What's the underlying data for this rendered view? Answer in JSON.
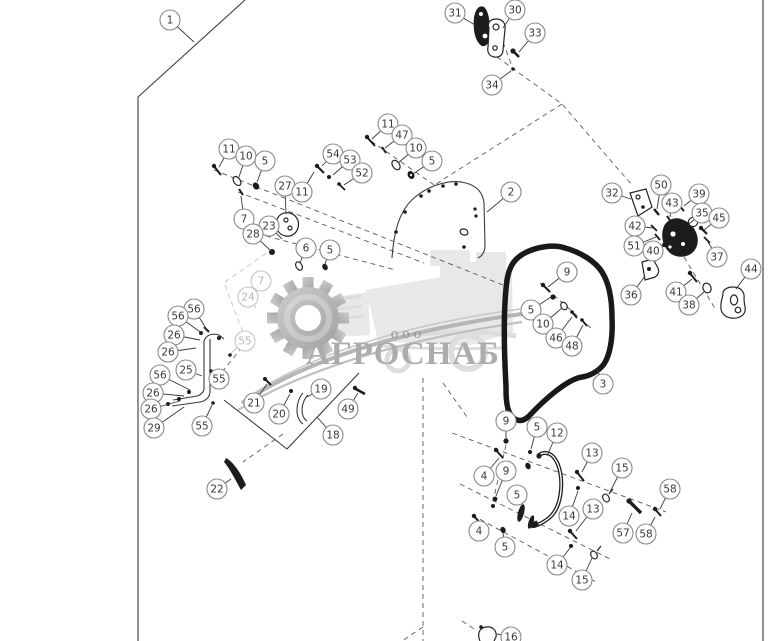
{
  "watermark": {
    "company": "АГРОСНАБ",
    "org_prefix": "ооо",
    "text_color": "#a8a8a8",
    "prefix_color": "#8f8f8f",
    "graphic_color": "#e7e7e7",
    "gear_light": "#cacaca",
    "gear_dark": "#9d9d9d"
  },
  "colors": {
    "background": "#ffffff",
    "border_line": "#3a3a3a",
    "dashed_line": "#5a5a5a",
    "leader_line": "#3a3a3a",
    "part_dark": "#1c1c1c",
    "seal": "#191919",
    "callout_stroke": "#8a8a8a",
    "callout_fill": "#ffffff",
    "callout_text": "#3a3a3a",
    "callout_light_stroke": "#c4c4c4",
    "callout_light_text": "#b8b8b8"
  },
  "callouts": [
    {
      "n": "1",
      "x": 170,
      "y": 20,
      "lx": 194,
      "ly": 42
    },
    {
      "n": "2",
      "x": 511,
      "y": 192,
      "lx": 487,
      "ly": 212
    },
    {
      "n": "3",
      "x": 603,
      "y": 384,
      "lx": 597,
      "ly": 369
    },
    {
      "n": "31",
      "x": 455,
      "y": 13,
      "lx": 475,
      "ly": 25
    },
    {
      "n": "30",
      "x": 515,
      "y": 10,
      "lx": 503,
      "ly": 28
    },
    {
      "n": "33",
      "x": 535,
      "y": 33,
      "lx": 519,
      "ly": 52
    },
    {
      "n": "34",
      "x": 492,
      "y": 85,
      "lx": 511,
      "ly": 71
    },
    {
      "n": "11",
      "x": 229,
      "y": 149,
      "lx": 219,
      "ly": 167
    },
    {
      "n": "10",
      "x": 246,
      "y": 156,
      "lx": 239,
      "ly": 177
    },
    {
      "n": "5",
      "x": 265,
      "y": 161,
      "lx": 257,
      "ly": 182
    },
    {
      "n": "54",
      "x": 333,
      "y": 154,
      "lx": 322,
      "ly": 166
    },
    {
      "n": "53",
      "x": 350,
      "y": 160,
      "lx": 333,
      "ly": 175
    },
    {
      "n": "52",
      "x": 362,
      "y": 173,
      "lx": 344,
      "ly": 185
    },
    {
      "n": "27",
      "x": 285,
      "y": 186,
      "lx": 286,
      "ly": 214
    },
    {
      "n": "11",
      "x": 302,
      "y": 192,
      "lx": 314,
      "ly": 172
    },
    {
      "n": "7",
      "x": 244,
      "y": 219,
      "lx": 241,
      "ly": 196
    },
    {
      "n": "23",
      "x": 269,
      "y": 226,
      "lx": 282,
      "ly": 239
    },
    {
      "n": "28",
      "x": 253,
      "y": 234,
      "lx": 271,
      "ly": 251
    },
    {
      "n": "6",
      "x": 306,
      "y": 248,
      "lx": 300,
      "ly": 263
    },
    {
      "n": "5",
      "x": 330,
      "y": 250,
      "lx": 325,
      "ly": 264
    },
    {
      "n": "11",
      "x": 388,
      "y": 124,
      "lx": 372,
      "ly": 139
    },
    {
      "n": "47",
      "x": 402,
      "y": 135,
      "lx": 385,
      "ly": 148
    },
    {
      "n": "10",
      "x": 416,
      "y": 148,
      "lx": 398,
      "ly": 163
    },
    {
      "n": "5",
      "x": 432,
      "y": 161,
      "lx": 413,
      "ly": 174
    },
    {
      "n": "7",
      "x": 261,
      "y": 281,
      "lx": 252,
      "ly": 291,
      "light": true
    },
    {
      "n": "24",
      "x": 248,
      "y": 297,
      "lx": 256,
      "ly": 308,
      "light": true
    },
    {
      "n": "55",
      "x": 245,
      "y": 341,
      "lx": 231,
      "ly": 353,
      "light": true
    },
    {
      "n": "32",
      "x": 612,
      "y": 193,
      "lx": 631,
      "ly": 199
    },
    {
      "n": "50",
      "x": 661,
      "y": 185,
      "lx": 657,
      "ly": 209
    },
    {
      "n": "43",
      "x": 672,
      "y": 203,
      "lx": 670,
      "ly": 217
    },
    {
      "n": "39",
      "x": 699,
      "y": 194,
      "lx": 684,
      "ly": 206
    },
    {
      "n": "42",
      "x": 635,
      "y": 226,
      "lx": 653,
      "ly": 228
    },
    {
      "n": "35",
      "x": 702,
      "y": 213,
      "lx": 689,
      "ly": 224
    },
    {
      "n": "45",
      "x": 719,
      "y": 218,
      "lx": 704,
      "ly": 230
    },
    {
      "n": "51",
      "x": 634,
      "y": 246,
      "lx": 656,
      "ly": 237
    },
    {
      "n": "40",
      "x": 653,
      "y": 251,
      "lx": 663,
      "ly": 245
    },
    {
      "n": "37",
      "x": 717,
      "y": 257,
      "lx": 708,
      "ly": 242
    },
    {
      "n": "36",
      "x": 631,
      "y": 295,
      "lx": 645,
      "ly": 276
    },
    {
      "n": "41",
      "x": 676,
      "y": 292,
      "lx": 692,
      "ly": 279
    },
    {
      "n": "38",
      "x": 689,
      "y": 305,
      "lx": 704,
      "ly": 292
    },
    {
      "n": "44",
      "x": 751,
      "y": 269,
      "lx": 736,
      "ly": 289
    },
    {
      "n": "9",
      "x": 567,
      "y": 272,
      "lx": 548,
      "ly": 287
    },
    {
      "n": "5",
      "x": 531,
      "y": 310,
      "lx": 551,
      "ly": 297
    },
    {
      "n": "10",
      "x": 543,
      "y": 324,
      "lx": 562,
      "ly": 308
    },
    {
      "n": "46",
      "x": 556,
      "y": 338,
      "lx": 572,
      "ly": 317
    },
    {
      "n": "48",
      "x": 572,
      "y": 346,
      "lx": 583,
      "ly": 325
    },
    {
      "n": "56",
      "x": 194,
      "y": 309,
      "lx": 207,
      "ly": 330
    },
    {
      "n": "56",
      "x": 178,
      "y": 316,
      "lx": 203,
      "ly": 334
    },
    {
      "n": "26",
      "x": 174,
      "y": 335,
      "lx": 200,
      "ly": 340
    },
    {
      "n": "26",
      "x": 168,
      "y": 352,
      "lx": 196,
      "ly": 348
    },
    {
      "n": "25",
      "x": 186,
      "y": 370,
      "lx": 202,
      "ly": 376
    },
    {
      "n": "55",
      "x": 219,
      "y": 379,
      "lx": 212,
      "ly": 372
    },
    {
      "n": "56",
      "x": 160,
      "y": 375,
      "lx": 190,
      "ly": 390
    },
    {
      "n": "26",
      "x": 153,
      "y": 393,
      "lx": 184,
      "ly": 396
    },
    {
      "n": "26",
      "x": 151,
      "y": 409,
      "lx": 180,
      "ly": 401
    },
    {
      "n": "29",
      "x": 154,
      "y": 428,
      "lx": 184,
      "ly": 407
    },
    {
      "n": "55",
      "x": 202,
      "y": 426,
      "lx": 212,
      "ly": 405
    },
    {
      "n": "21",
      "x": 254,
      "y": 403,
      "lx": 267,
      "ly": 384
    },
    {
      "n": "20",
      "x": 279,
      "y": 414,
      "lx": 290,
      "ly": 394
    },
    {
      "n": "19",
      "x": 321,
      "y": 389,
      "lx": 307,
      "ly": 397
    },
    {
      "n": "49",
      "x": 348,
      "y": 409,
      "lx": 358,
      "ly": 393
    },
    {
      "n": "18",
      "x": 333,
      "y": 435,
      "lx": 317,
      "ly": 417
    },
    {
      "n": "22",
      "x": 217,
      "y": 489,
      "lx": 231,
      "ly": 479
    },
    {
      "n": "9",
      "x": 506,
      "y": 421,
      "lx": 506,
      "ly": 439
    },
    {
      "n": "5",
      "x": 537,
      "y": 427,
      "lx": 531,
      "ly": 449
    },
    {
      "n": "12",
      "x": 557,
      "y": 433,
      "lx": 547,
      "ly": 456
    },
    {
      "n": "13",
      "x": 592,
      "y": 453,
      "lx": 582,
      "ly": 472
    },
    {
      "n": "15",
      "x": 622,
      "y": 468,
      "lx": 609,
      "ly": 494
    },
    {
      "n": "58",
      "x": 670,
      "y": 489,
      "lx": 660,
      "ly": 509
    },
    {
      "n": "4",
      "x": 484,
      "y": 476,
      "lx": 499,
      "ly": 458
    },
    {
      "n": "9",
      "x": 506,
      "y": 471,
      "lx": 496,
      "ly": 496
    },
    {
      "n": "5",
      "x": 517,
      "y": 495,
      "lx": 520,
      "ly": 505
    },
    {
      "n": "14",
      "x": 569,
      "y": 516,
      "lx": 578,
      "ly": 491
    },
    {
      "n": "13",
      "x": 593,
      "y": 509,
      "lx": 576,
      "ly": 531
    },
    {
      "n": "57",
      "x": 623,
      "y": 533,
      "lx": 632,
      "ly": 513
    },
    {
      "n": "58",
      "x": 646,
      "y": 534,
      "lx": 655,
      "ly": 517
    },
    {
      "n": "4",
      "x": 479,
      "y": 531,
      "lx": 478,
      "ly": 524
    },
    {
      "n": "5",
      "x": 505,
      "y": 547,
      "lx": 503,
      "ly": 533
    },
    {
      "n": "14",
      "x": 557,
      "y": 565,
      "lx": 570,
      "ly": 548
    },
    {
      "n": "15",
      "x": 582,
      "y": 580,
      "lx": 592,
      "ly": 558
    },
    {
      "n": "16",
      "x": 511,
      "y": 637,
      "lx": 497,
      "ly": 634
    }
  ]
}
